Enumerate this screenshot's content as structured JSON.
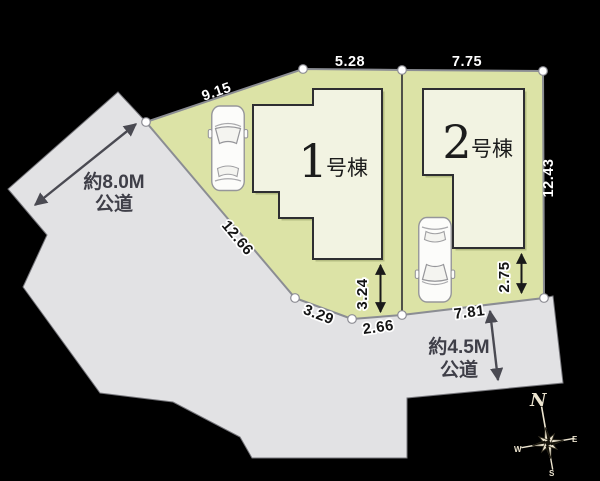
{
  "colors": {
    "background": "#000000",
    "road": "#e2e2e4",
    "site": "#dce3a6",
    "building": "#f2f3e2",
    "building_outline": "#2e2e31",
    "boundary_line": "#8b8d93",
    "dim_text_light": "#ffffff",
    "dim_text_dark": "#141414",
    "road_label": "#3f3f48",
    "arrow_dark": "#1a1a1a",
    "arrow_gray": "#4a4a52",
    "compass": "#ece4cf",
    "car_body": "#fcfcfa"
  },
  "site": {
    "buildings": [
      {
        "number": "1",
        "suffix": "号棟"
      },
      {
        "number": "2",
        "suffix": "号棟"
      }
    ],
    "dimensions": {
      "nw_edge": "9.15",
      "n_edge_plot1": "5.28",
      "n_edge_plot2": "7.75",
      "e_edge": "12.43",
      "sw_edge": "12.66",
      "s_edge_1": "3.29",
      "s_edge_2": "2.66",
      "s_edge_3": "7.81",
      "plot1_setback": "3.24",
      "plot2_setback": "2.75"
    },
    "roads": {
      "west": {
        "width_label": "約8.0M",
        "type_label": "公道"
      },
      "south": {
        "width_label": "約4.5M",
        "type_label": "公道"
      }
    },
    "compass": {
      "n": "N",
      "e": "E",
      "s": "S",
      "w": "W"
    }
  }
}
